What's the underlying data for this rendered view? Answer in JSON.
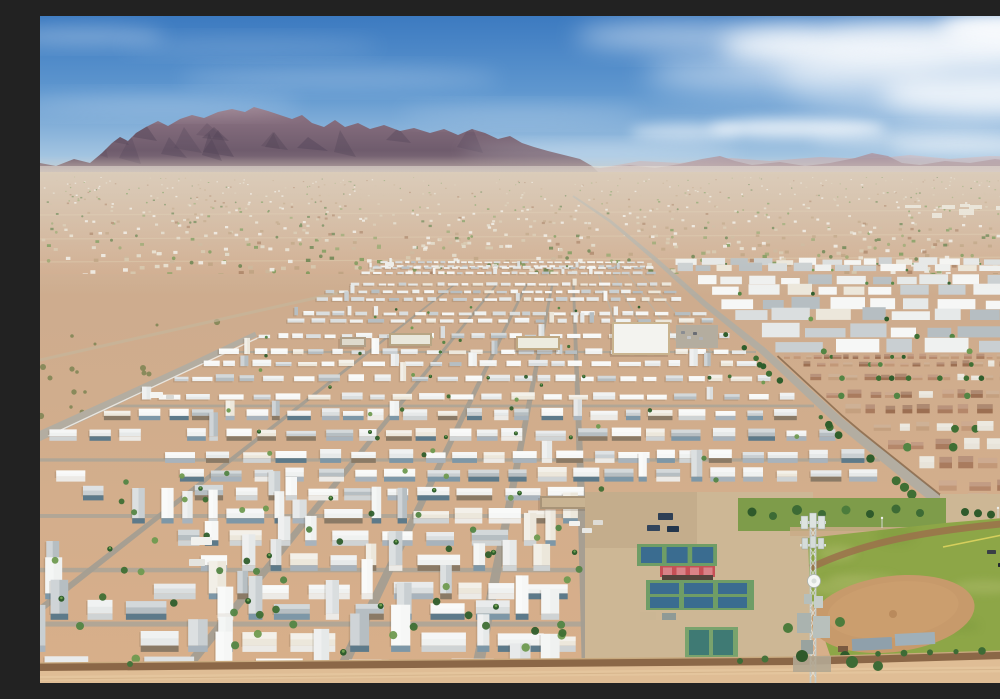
{
  "meta": {
    "title": "Aerial drone photo of a desert mobile-home park community with mountains on the horizon, pickleball courts, a softball field and a cell tower"
  },
  "scene": {
    "sky": {
      "stops": [
        "#3c7ac0",
        "#5f97cf",
        "#a7c7e2",
        "#d9e7f1"
      ]
    },
    "clouds": [
      [
        870,
        30,
        190,
        26,
        0.85,
        12
      ],
      [
        960,
        78,
        120,
        22,
        0.8,
        12
      ],
      [
        755,
        58,
        150,
        20,
        0.5,
        14
      ],
      [
        655,
        20,
        120,
        14,
        0.5,
        12
      ],
      [
        985,
        12,
        85,
        18,
        0.9,
        9
      ],
      [
        757,
        112,
        88,
        10,
        0.7,
        6
      ],
      [
        645,
        116,
        55,
        8,
        0.5,
        6
      ],
      [
        880,
        122,
        110,
        9,
        0.45,
        8
      ],
      [
        300,
        62,
        160,
        10,
        0.22,
        10
      ],
      [
        120,
        88,
        140,
        9,
        0.25,
        10
      ],
      [
        45,
        20,
        80,
        9,
        0.3,
        9
      ],
      [
        480,
        98,
        120,
        8,
        0.2,
        10
      ],
      [
        210,
        30,
        130,
        8,
        0.16,
        10
      ],
      [
        560,
        135,
        140,
        7,
        0.3,
        8
      ],
      [
        940,
        131,
        90,
        8,
        0.5,
        7
      ],
      [
        900,
        60,
        160,
        45,
        0.4,
        14
      ]
    ],
    "mountains": {
      "fill_top": "#8f7585",
      "fill_mid": "#6f5c6d",
      "fill_base": "#9c8890",
      "shadow": "#544659",
      "far_fill": "#a9929e",
      "far2_fill": "#c2aeb5",
      "main": [
        [
          -10,
          158
        ],
        [
          0,
          147
        ],
        [
          16,
          150
        ],
        [
          34,
          143
        ],
        [
          50,
          147
        ],
        [
          62,
          137
        ],
        [
          72,
          127
        ],
        [
          80,
          121
        ],
        [
          88,
          125
        ],
        [
          96,
          117
        ],
        [
          106,
          111
        ],
        [
          118,
          105
        ],
        [
          128,
          110
        ],
        [
          140,
          103
        ],
        [
          152,
          99
        ],
        [
          164,
          102
        ],
        [
          178,
          96
        ],
        [
          192,
          93
        ],
        [
          205,
          96
        ],
        [
          214,
          91
        ],
        [
          228,
          95
        ],
        [
          240,
          99
        ],
        [
          252,
          103
        ],
        [
          262,
          99
        ],
        [
          272,
          107
        ],
        [
          284,
          111
        ],
        [
          295,
          104
        ],
        [
          305,
          111
        ],
        [
          318,
          107
        ],
        [
          330,
          113
        ],
        [
          344,
          109
        ],
        [
          360,
          115
        ],
        [
          374,
          112
        ],
        [
          390,
          117
        ],
        [
          404,
          113
        ],
        [
          418,
          119
        ],
        [
          432,
          113
        ],
        [
          445,
          117
        ],
        [
          458,
          123
        ],
        [
          470,
          120
        ],
        [
          482,
          127
        ],
        [
          494,
          131
        ],
        [
          508,
          135
        ],
        [
          524,
          139
        ],
        [
          540,
          143
        ],
        [
          552,
          150
        ],
        [
          560,
          158
        ],
        [
          565,
          166
        ]
      ],
      "far": [
        [
          430,
          158
        ],
        [
          470,
          152
        ],
        [
          500,
          155
        ],
        [
          530,
          148
        ],
        [
          560,
          152
        ],
        [
          590,
          149
        ],
        [
          615,
          152
        ],
        [
          640,
          148
        ],
        [
          662,
          143
        ],
        [
          680,
          140
        ],
        [
          695,
          145
        ],
        [
          712,
          149
        ],
        [
          740,
          146
        ],
        [
          765,
          150
        ],
        [
          790,
          147
        ],
        [
          815,
          142
        ],
        [
          832,
          137
        ],
        [
          848,
          140
        ],
        [
          862,
          147
        ],
        [
          880,
          149
        ],
        [
          905,
          145
        ],
        [
          930,
          147
        ],
        [
          955,
          143
        ],
        [
          978,
          146
        ],
        [
          1000,
          144
        ]
      ],
      "far2": [
        [
          560,
          152
        ],
        [
          600,
          145
        ],
        [
          640,
          147
        ],
        [
          690,
          142
        ],
        [
          730,
          145
        ],
        [
          780,
          141
        ],
        [
          830,
          143
        ],
        [
          870,
          139
        ],
        [
          910,
          143
        ],
        [
          950,
          140
        ],
        [
          1000,
          141
        ]
      ]
    },
    "valley": {
      "base_top": "#cbb49c",
      "base_bottom": "#d0aa8b",
      "speckle_count": 1050,
      "palette": [
        "#f1eee7",
        "#f1eee7",
        "#f1eee7",
        "#e9e2d2",
        "#e2dac9",
        "#e2dac9",
        "#d5c4a9",
        "#d5c4a9",
        "#bb9c79",
        "#bb9c79",
        "#a87e60",
        "#93a065",
        "#5f7a42",
        "#74924f",
        "#c9b295"
      ]
    },
    "park": {
      "dirt_top": "#cdac8e",
      "dirt_bottom": "#d8af8a",
      "street": "#a49e92",
      "cross_street": "#aaa498",
      "roof_palette": [
        "#f6f7f6",
        "#f6f7f6",
        "#eff1f0",
        "#eff1f0",
        "#e6e9e9",
        "#dadedf",
        "#c9cfd2",
        "#b6bec2",
        "#ece7db"
      ],
      "wall_palette": [
        "#eceae6",
        "#cfd3d4",
        "#a8b3bc",
        "#7d97a7",
        "#8a7a66",
        "#5d7a8a"
      ],
      "tree_greens": [
        "#3f6f34",
        "#538544",
        "#6f9a50",
        "#2f5e2c"
      ],
      "rows": 26,
      "street_bottoms": [
        -85,
        140,
        298,
        436,
        548
      ],
      "tree_count": 95
    },
    "east": {
      "rows": 8,
      "terracotta_rows": 10,
      "terracotta": [
        "#b5876a",
        "#a97b5e",
        "#c29878",
        "#9c6f52",
        "#c4a07f"
      ],
      "terracotta_white_mix": 0.08,
      "street_bottoms": [
        700,
        790,
        880,
        960
      ]
    },
    "roads": {
      "color": "#b3ada1",
      "fence": "#eeece6",
      "main_pts": [
        [
          533,
          180
        ],
        [
          570,
          205
        ],
        [
          615,
          243
        ],
        [
          665,
          288
        ],
        [
          722,
          334
        ],
        [
          800,
          406
        ],
        [
          880,
          470
        ],
        [
          945,
          521
        ],
        [
          1000,
          558
        ]
      ],
      "left_pts": [
        [
          216,
          318
        ],
        [
          150,
          350
        ],
        [
          80,
          383
        ],
        [
          0,
          420
        ],
        [
          -40,
          438
        ]
      ],
      "spur_pts": [
        [
          938,
          518
        ],
        [
          962,
          560
        ],
        [
          980,
          606
        ],
        [
          992,
          650
        ]
      ],
      "top_boundary": [
        [
          302,
          276
        ],
        [
          0,
          344
        ]
      ]
    },
    "buildings": [
      {
        "n": "community-center",
        "x": 572,
        "y": 306,
        "w": 58,
        "h": 33,
        "wall": "#c9b48f",
        "roof": "#f3f3ef"
      },
      {
        "n": "clubhouse",
        "x": 476,
        "y": 320,
        "w": 44,
        "h": 14,
        "wall": "#bfa883",
        "roof": "#edebdf"
      },
      {
        "n": "office-building",
        "x": 349,
        "y": 317,
        "w": 43,
        "h": 13,
        "wall": "#b7a584",
        "roof": "#e9e7db"
      },
      {
        "n": "annex-building",
        "x": 300,
        "y": 321,
        "w": 26,
        "h": 10,
        "wall": "#b0a088",
        "roof": "#dedacc"
      },
      {
        "n": "shed-row-1",
        "x": 500,
        "y": 480,
        "w": 52,
        "h": 13,
        "wall": "#a89478",
        "roof": "#c8b392"
      },
      {
        "n": "shed-row-2",
        "x": 560,
        "y": 478,
        "w": 58,
        "h": 14,
        "wall": "#9e8a70",
        "roof": "#cdb997"
      },
      {
        "n": "shed-row-3",
        "x": 627,
        "y": 477,
        "w": 62,
        "h": 13,
        "wall": "#a08c72",
        "roof": "#c3ae8d"
      },
      {
        "n": "pro-shop",
        "x": 688,
        "y": 525,
        "w": 22,
        "h": 36,
        "wall": "#9c7a55",
        "roof": "#b29271"
      },
      {
        "n": "green-roof-shed",
        "x": 594,
        "y": 627,
        "w": 34,
        "h": 17,
        "wall": "#8a8a7a",
        "roof": "#4e8a55"
      },
      {
        "n": "small-shed",
        "x": 632,
        "y": 629,
        "w": 16,
        "h": 13,
        "wall": "#7a513c",
        "roof": "#8a5a40"
      }
    ],
    "parking": {
      "x": 636,
      "y": 309,
      "w": 42,
      "h": 23,
      "fill": "#b4ad9f"
    },
    "complex": {
      "paving": "#cdb795",
      "paving2": "#c3ac8b",
      "court_green": "#6f9d66",
      "court_green2": "#79a36d",
      "court_blue": "#3a6c90",
      "court_teal": "#3f7a74",
      "red_base": "#c65056",
      "red_stripe": "#d98388",
      "bleacher": "#54443c",
      "groupA": {
        "x": 597,
        "y": 528,
        "w": 80,
        "h": 22,
        "courts": 3
      },
      "red": {
        "x": 620,
        "y": 550,
        "w": 55,
        "h": 11
      },
      "groupB": {
        "x": 606,
        "y": 564,
        "w": 108,
        "h": 30,
        "cols": 3,
        "rows": 2
      },
      "groupC": {
        "x": 645,
        "y": 611,
        "w": 53,
        "h": 31,
        "courts": 2
      },
      "lawn": {
        "x": 698,
        "y": 482,
        "w": 208,
        "h": 33,
        "fill": "#7e9c4a"
      }
    },
    "ballfield": {
      "grass": "#8da647",
      "grass2": "#7c983d",
      "light": "#a8b765",
      "dirt": "#c79a6b",
      "track": "#9b714b",
      "foul": "#ded45f",
      "fence": "#5a4a3a",
      "dugout1": "#8fa0ab",
      "dugout2": "#9fb0ba",
      "poly": [
        [
          768,
          522
        ],
        [
          905,
          507
        ],
        [
          1000,
          499
        ],
        [
          1000,
          648
        ],
        [
          793,
          648
        ],
        [
          770,
          580
        ]
      ]
    },
    "tower": {
      "metal": "#c3cac7",
      "light": "#e2e7e4",
      "dark": "#8f9a96",
      "x": 773,
      "top": 497
    },
    "wall": {
      "fill": "#8b6747",
      "top": "#c8a97e",
      "shadow": "#7a5230"
    },
    "bottom": {
      "fill": "#dfbd95",
      "fill2": "#eacda5"
    },
    "vehicles": [
      [
        529,
        505,
        11,
        5,
        "#f2f2ef"
      ],
      [
        542,
        512,
        10,
        5,
        "#e8e8e4"
      ],
      [
        553,
        504,
        10,
        5,
        "#dedcd6"
      ],
      [
        618,
        497,
        15,
        7,
        "#2e3f55"
      ],
      [
        607,
        509,
        13,
        6,
        "#33455c"
      ],
      [
        627,
        510,
        12,
        6,
        "#24364c"
      ],
      [
        641,
        315,
        4,
        3,
        "#8a8d92"
      ],
      [
        647,
        320,
        4,
        3,
        "#c2c4c6"
      ],
      [
        653,
        316,
        4,
        3,
        "#6a6d74"
      ],
      [
        659,
        321,
        4,
        3,
        "#b0b2b6"
      ],
      [
        110,
        376,
        13,
        6,
        "#f4f4f1"
      ],
      [
        126,
        379,
        8,
        4,
        "#d8d8d4"
      ],
      [
        151,
        521,
        21,
        8,
        "#f1f1ee"
      ],
      [
        149,
        543,
        16,
        7,
        "#e4e4df"
      ],
      [
        345,
        246,
        9,
        4,
        "#eeeeea"
      ],
      [
        947,
        534,
        9,
        4,
        "#3a3f46"
      ],
      [
        958,
        547,
        8,
        4,
        "#23282e"
      ]
    ]
  }
}
